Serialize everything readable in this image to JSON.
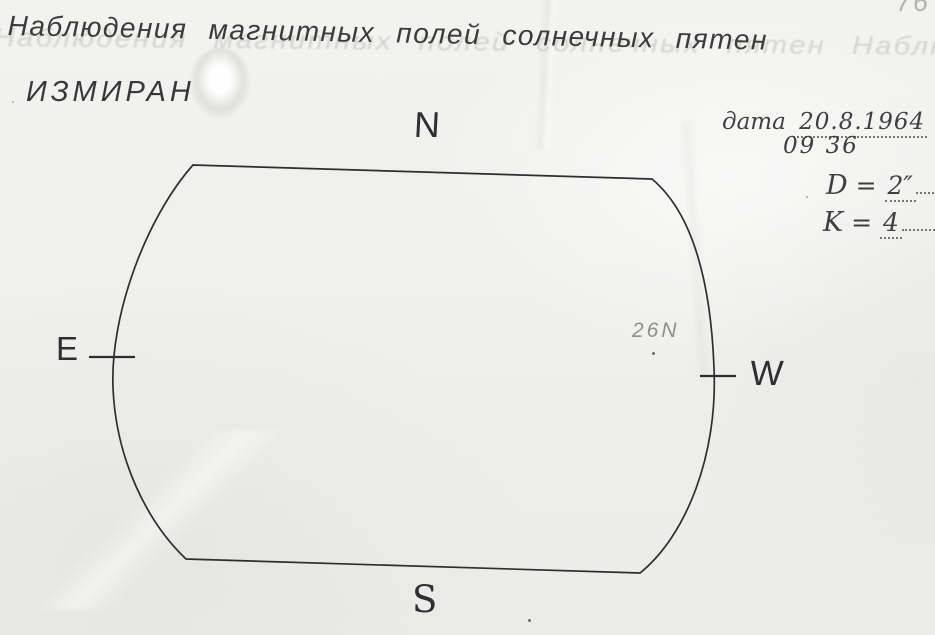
{
  "page": {
    "title": "Наблюдения магнитных полей солнечных пятен",
    "ghost_text": "Наблюдения магнитных полей солнечных пятен Наблюдения",
    "organization": "ИЗМИРАН",
    "page_number": "76"
  },
  "observation": {
    "date_label": "дата",
    "date_value": "20.8.1964",
    "time_value": "09 36",
    "fields": [
      {
        "label": "D",
        "eq": "=",
        "value": "2″"
      },
      {
        "label": "K",
        "eq": "=",
        "value": "4"
      }
    ]
  },
  "diagram": {
    "compass_labels": {
      "north": "N",
      "east": "E",
      "west": "W",
      "south": "S"
    },
    "annotation": "26N",
    "ink_color": "#2e2e2e",
    "pencil_color": "#8f8f8b",
    "paper_color": "#f0f0ee"
  }
}
